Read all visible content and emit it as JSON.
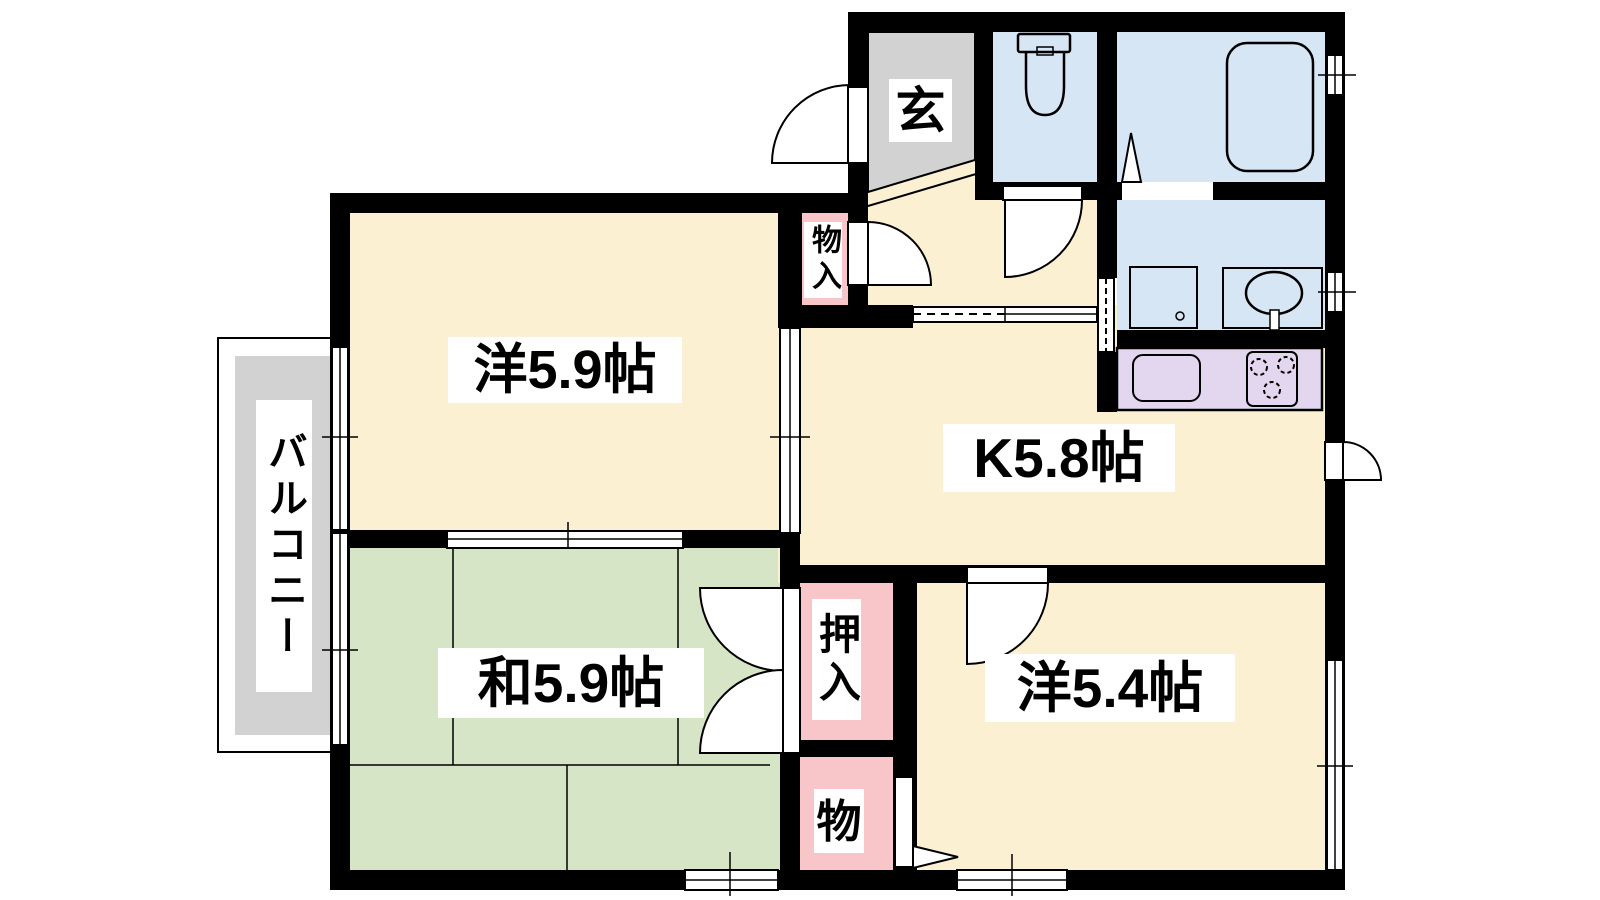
{
  "colors": {
    "wall": "#000000",
    "room_cream": "#FBF0D2",
    "tatami_green": "#D6E5C6",
    "wet_blue": "#D7E6F5",
    "closet_pink": "#F8C6C8",
    "kitchen_lavender": "#E3D6EF",
    "floor_gray": "#D2D2D2",
    "label_bg": "#FFFFFF",
    "text": "#000000"
  },
  "rooms": {
    "western1": {
      "label": "洋5.9帖",
      "size_jo": "5.9"
    },
    "kitchen": {
      "label": "K5.8帖",
      "size_jo": "5.8"
    },
    "japanese": {
      "label": "和5.9帖",
      "size_jo": "5.9"
    },
    "western2": {
      "label": "洋5.4帖",
      "size_jo": "5.4"
    },
    "entrance": {
      "label": "玄"
    },
    "balcony": {
      "label": "バルコニー"
    },
    "closet_hall": {
      "label": "物入"
    },
    "closet_oshiire": {
      "label": "押入"
    },
    "closet_mono": {
      "label": "物"
    }
  }
}
